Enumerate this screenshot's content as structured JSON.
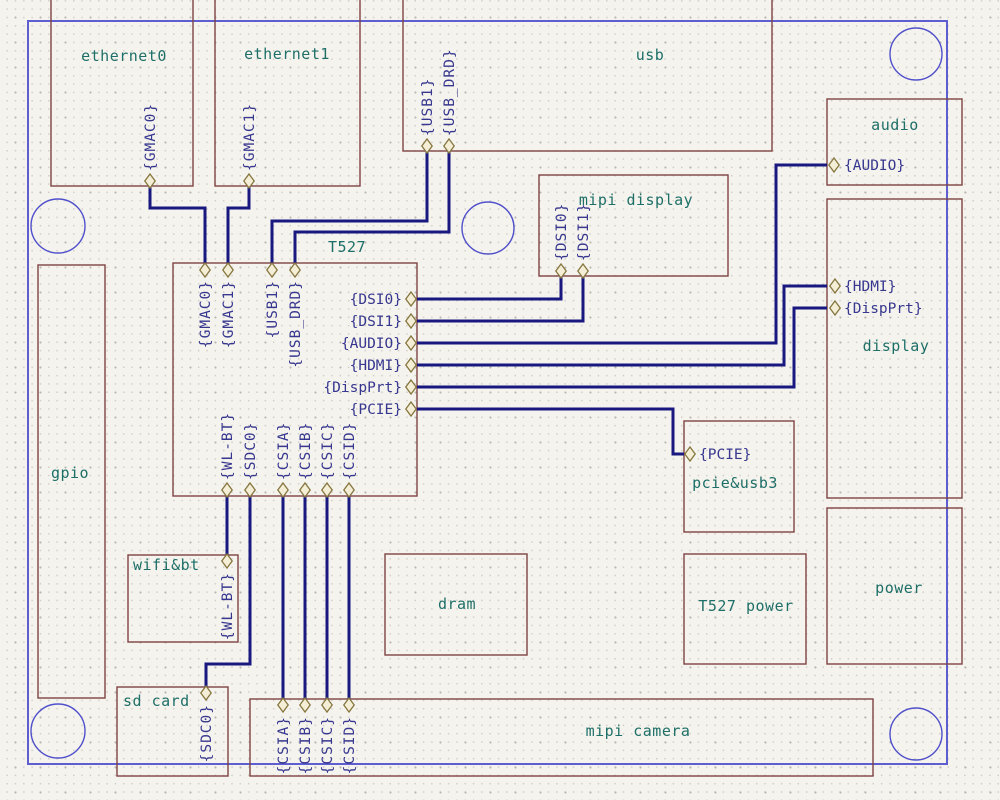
{
  "schematic": {
    "canvas": {
      "width": 1000,
      "height": 800
    },
    "colors": {
      "background": "#f5f3ed",
      "grid_dot_minor": "#d0cec7",
      "grid_dot_major": "#b8b6af",
      "block_outline": "#7f4343",
      "block_label": "#1d6f68",
      "pin_label": "#37378f",
      "wire": "#181880",
      "pin_outline": "#85763f",
      "pin_fill": "#f5eed6",
      "board_border": "#5e5ed0",
      "mounting_hole": "#5050cc"
    },
    "board_border": {
      "x": 28,
      "y": 21,
      "width": 919,
      "height": 743
    },
    "mounting_holes": [
      {
        "cx": 58,
        "cy": 226,
        "r": 27
      },
      {
        "cx": 916,
        "cy": 54,
        "r": 26
      },
      {
        "cx": 488,
        "cy": 228,
        "r": 26
      },
      {
        "cx": 58,
        "cy": 731,
        "r": 27
      },
      {
        "cx": 916,
        "cy": 734,
        "r": 26
      }
    ],
    "blocks": [
      {
        "id": "ethernet0",
        "label": "ethernet0",
        "x": 51,
        "y": -10,
        "width": 142,
        "height": 196,
        "label_x": 124,
        "label_y": 61,
        "label_anchor": "middle",
        "pins": [
          {
            "label": "{GMAC0}",
            "cx": 150,
            "cy": 181,
            "dir": "up",
            "lx": 155,
            "ly": 171
          }
        ]
      },
      {
        "id": "ethernet1",
        "label": "ethernet1",
        "x": 215,
        "y": -10,
        "width": 145,
        "height": 196,
        "label_x": 287,
        "label_y": 59,
        "label_anchor": "middle",
        "pins": [
          {
            "label": "{GMAC1}",
            "cx": 249,
            "cy": 181,
            "dir": "up",
            "lx": 254,
            "ly": 171
          }
        ]
      },
      {
        "id": "usb",
        "label": "usb",
        "x": 403,
        "y": -10,
        "width": 369,
        "height": 161,
        "label_x": 650,
        "label_y": 60,
        "label_anchor": "middle",
        "pins": [
          {
            "label": "{USB1}",
            "cx": 427,
            "cy": 146,
            "dir": "up",
            "lx": 432,
            "ly": 136
          },
          {
            "label": "{USB_DRD}",
            "cx": 449,
            "cy": 146,
            "dir": "up",
            "lx": 454,
            "ly": 136
          }
        ]
      },
      {
        "id": "audio",
        "label": "audio",
        "x": 827,
        "y": 99,
        "width": 135,
        "height": 86,
        "label_x": 895,
        "label_y": 130,
        "label_anchor": "middle",
        "pins": [
          {
            "label": "{AUDIO}",
            "cx": 834,
            "cy": 165,
            "dir": "right",
            "lx": 844,
            "ly": 170
          }
        ]
      },
      {
        "id": "mipi-display",
        "label": "mipi display",
        "x": 539,
        "y": 175,
        "width": 189,
        "height": 101,
        "label_x": 636,
        "label_y": 205,
        "label_anchor": "middle",
        "pins": [
          {
            "label": "{DSI0}",
            "cx": 561,
            "cy": 271,
            "dir": "up",
            "lx": 566,
            "ly": 261
          },
          {
            "label": "{DSI1}",
            "cx": 583,
            "cy": 271,
            "dir": "up",
            "lx": 588,
            "ly": 261
          }
        ]
      },
      {
        "id": "display",
        "label": "display",
        "x": 827,
        "y": 199,
        "width": 135,
        "height": 299,
        "label_x": 896,
        "label_y": 351,
        "label_anchor": "middle",
        "pins": [
          {
            "label": "{HDMI}",
            "cx": 835,
            "cy": 286,
            "dir": "right",
            "lx": 844,
            "ly": 291
          },
          {
            "label": "{DispPrt}",
            "cx": 835,
            "cy": 308,
            "dir": "right",
            "lx": 844,
            "ly": 313
          }
        ]
      },
      {
        "id": "t527",
        "label": "T527",
        "x": 173,
        "y": 263,
        "width": 244,
        "height": 233,
        "label_x": 347,
        "label_y": 252,
        "label_anchor": "middle",
        "pins": [
          {
            "label": "{GMAC0}",
            "cx": 205,
            "cy": 270,
            "dir": "down",
            "lx": 210,
            "ly": 280
          },
          {
            "label": "{GMAC1}",
            "cx": 228,
            "cy": 270,
            "dir": "down",
            "lx": 233,
            "ly": 280
          },
          {
            "label": "{USB1}",
            "cx": 272,
            "cy": 270,
            "dir": "down",
            "lx": 277,
            "ly": 280
          },
          {
            "label": "{USB_DRD}",
            "cx": 295,
            "cy": 270,
            "dir": "down",
            "lx": 300,
            "ly": 280
          },
          {
            "label": "{DSI0}",
            "cx": 411,
            "cy": 299,
            "dir": "left",
            "lx": 402,
            "ly": 304
          },
          {
            "label": "{DSI1}",
            "cx": 411,
            "cy": 321,
            "dir": "left",
            "lx": 402,
            "ly": 326
          },
          {
            "label": "{AUDIO}",
            "cx": 411,
            "cy": 343,
            "dir": "left",
            "lx": 402,
            "ly": 348
          },
          {
            "label": "{HDMI}",
            "cx": 411,
            "cy": 365,
            "dir": "left",
            "lx": 402,
            "ly": 370
          },
          {
            "label": "{DispPrt}",
            "cx": 411,
            "cy": 387,
            "dir": "left",
            "lx": 402,
            "ly": 392
          },
          {
            "label": "{PCIE}",
            "cx": 411,
            "cy": 409,
            "dir": "left",
            "lx": 402,
            "ly": 414
          },
          {
            "label": "{WL-BT}",
            "cx": 227,
            "cy": 490,
            "dir": "up",
            "lx": 232,
            "ly": 480
          },
          {
            "label": "{SDC0}",
            "cx": 250,
            "cy": 490,
            "dir": "up",
            "lx": 255,
            "ly": 480
          },
          {
            "label": "{CSIA}",
            "cx": 283,
            "cy": 490,
            "dir": "up",
            "lx": 288,
            "ly": 480
          },
          {
            "label": "{CSIB}",
            "cx": 305,
            "cy": 490,
            "dir": "up",
            "lx": 310,
            "ly": 480
          },
          {
            "label": "{CSIC}",
            "cx": 327,
            "cy": 490,
            "dir": "up",
            "lx": 332,
            "ly": 480
          },
          {
            "label": "{CSID}",
            "cx": 349,
            "cy": 490,
            "dir": "up",
            "lx": 354,
            "ly": 480
          }
        ]
      },
      {
        "id": "gpio",
        "label": "gpio",
        "x": 38,
        "y": 265,
        "width": 67,
        "height": 433,
        "label_x": 70,
        "label_y": 478,
        "label_anchor": "middle",
        "pins": []
      },
      {
        "id": "pcie-usb3",
        "label": "pcie&usb3",
        "x": 684,
        "y": 421,
        "width": 110,
        "height": 111,
        "label_x": 735,
        "label_y": 488,
        "label_anchor": "middle",
        "pins": [
          {
            "label": "{PCIE}",
            "cx": 690,
            "cy": 454,
            "dir": "right",
            "lx": 699,
            "ly": 459
          }
        ]
      },
      {
        "id": "wifi-bt",
        "label": "wifi&bt",
        "x": 128,
        "y": 555,
        "width": 110,
        "height": 87,
        "label_x": 133,
        "label_y": 570,
        "label_anchor": "start",
        "pins": [
          {
            "label": "{WL-BT}",
            "cx": 227,
            "cy": 561,
            "dir": "down",
            "lx": 232,
            "ly": 572
          }
        ]
      },
      {
        "id": "dram",
        "label": "dram",
        "x": 385,
        "y": 554,
        "width": 142,
        "height": 101,
        "label_x": 457,
        "label_y": 609,
        "label_anchor": "middle",
        "pins": []
      },
      {
        "id": "t527-power",
        "label": "T527 power",
        "x": 684,
        "y": 554,
        "width": 122,
        "height": 110,
        "label_x": 746,
        "label_y": 611,
        "label_anchor": "middle",
        "pins": []
      },
      {
        "id": "power",
        "label": "power",
        "x": 827,
        "y": 508,
        "width": 135,
        "height": 156,
        "label_x": 899,
        "label_y": 593,
        "label_anchor": "middle",
        "pins": []
      },
      {
        "id": "sd-card",
        "label": "sd card",
        "x": 117,
        "y": 687,
        "width": 111,
        "height": 89,
        "label_x": 123,
        "label_y": 706,
        "label_anchor": "start",
        "pins": [
          {
            "label": "{SDC0}",
            "cx": 206,
            "cy": 693,
            "dir": "down",
            "lx": 211,
            "ly": 704
          }
        ]
      },
      {
        "id": "mipi-camera",
        "label": "mipi camera",
        "x": 250,
        "y": 699,
        "width": 623,
        "height": 77,
        "label_x": 638,
        "label_y": 736,
        "label_anchor": "middle",
        "pins": [
          {
            "label": "{CSIA}",
            "cx": 283,
            "cy": 705,
            "dir": "down",
            "lx": 288,
            "ly": 716
          },
          {
            "label": "{CSIB}",
            "cx": 305,
            "cy": 705,
            "dir": "down",
            "lx": 310,
            "ly": 716
          },
          {
            "label": "{CSIC}",
            "cx": 327,
            "cy": 705,
            "dir": "down",
            "lx": 332,
            "ly": 716
          },
          {
            "label": "{CSID}",
            "cx": 349,
            "cy": 705,
            "dir": "down",
            "lx": 354,
            "ly": 716
          }
        ]
      }
    ],
    "wires": [
      {
        "id": "gmac0",
        "points": [
          [
            150,
            186
          ],
          [
            150,
            208
          ],
          [
            205,
            208
          ],
          [
            205,
            263
          ]
        ]
      },
      {
        "id": "gmac1",
        "points": [
          [
            249,
            186
          ],
          [
            249,
            208
          ],
          [
            228,
            208
          ],
          [
            228,
            263
          ]
        ]
      },
      {
        "id": "usb1",
        "points": [
          [
            427,
            151
          ],
          [
            427,
            221
          ],
          [
            272,
            221
          ],
          [
            272,
            263
          ]
        ]
      },
      {
        "id": "usb-drd",
        "points": [
          [
            449,
            151
          ],
          [
            449,
            232
          ],
          [
            295,
            232
          ],
          [
            295,
            263
          ]
        ]
      },
      {
        "id": "dsi0",
        "points": [
          [
            417,
            299
          ],
          [
            561,
            299
          ],
          [
            561,
            276
          ]
        ]
      },
      {
        "id": "dsi1",
        "points": [
          [
            417,
            321
          ],
          [
            583,
            321
          ],
          [
            583,
            276
          ]
        ]
      },
      {
        "id": "audio",
        "points": [
          [
            417,
            343
          ],
          [
            776,
            343
          ],
          [
            776,
            165
          ],
          [
            827,
            165
          ]
        ]
      },
      {
        "id": "hdmi",
        "points": [
          [
            417,
            365
          ],
          [
            784,
            365
          ],
          [
            784,
            286
          ],
          [
            827,
            286
          ]
        ]
      },
      {
        "id": "dispprt",
        "points": [
          [
            417,
            387
          ],
          [
            794,
            387
          ],
          [
            794,
            308
          ],
          [
            827,
            308
          ]
        ]
      },
      {
        "id": "pcie",
        "points": [
          [
            417,
            409
          ],
          [
            673,
            409
          ],
          [
            673,
            454
          ],
          [
            684,
            454
          ]
        ]
      },
      {
        "id": "wl-bt",
        "points": [
          [
            227,
            496
          ],
          [
            227,
            555
          ]
        ]
      },
      {
        "id": "sdc0",
        "points": [
          [
            250,
            496
          ],
          [
            250,
            664
          ],
          [
            206,
            664
          ],
          [
            206,
            687
          ]
        ]
      },
      {
        "id": "csia",
        "points": [
          [
            283,
            496
          ],
          [
            283,
            699
          ]
        ]
      },
      {
        "id": "csib",
        "points": [
          [
            305,
            496
          ],
          [
            305,
            699
          ]
        ]
      },
      {
        "id": "csic",
        "points": [
          [
            327,
            496
          ],
          [
            327,
            699
          ]
        ]
      },
      {
        "id": "csid",
        "points": [
          [
            349,
            496
          ],
          [
            349,
            699
          ]
        ]
      }
    ]
  }
}
